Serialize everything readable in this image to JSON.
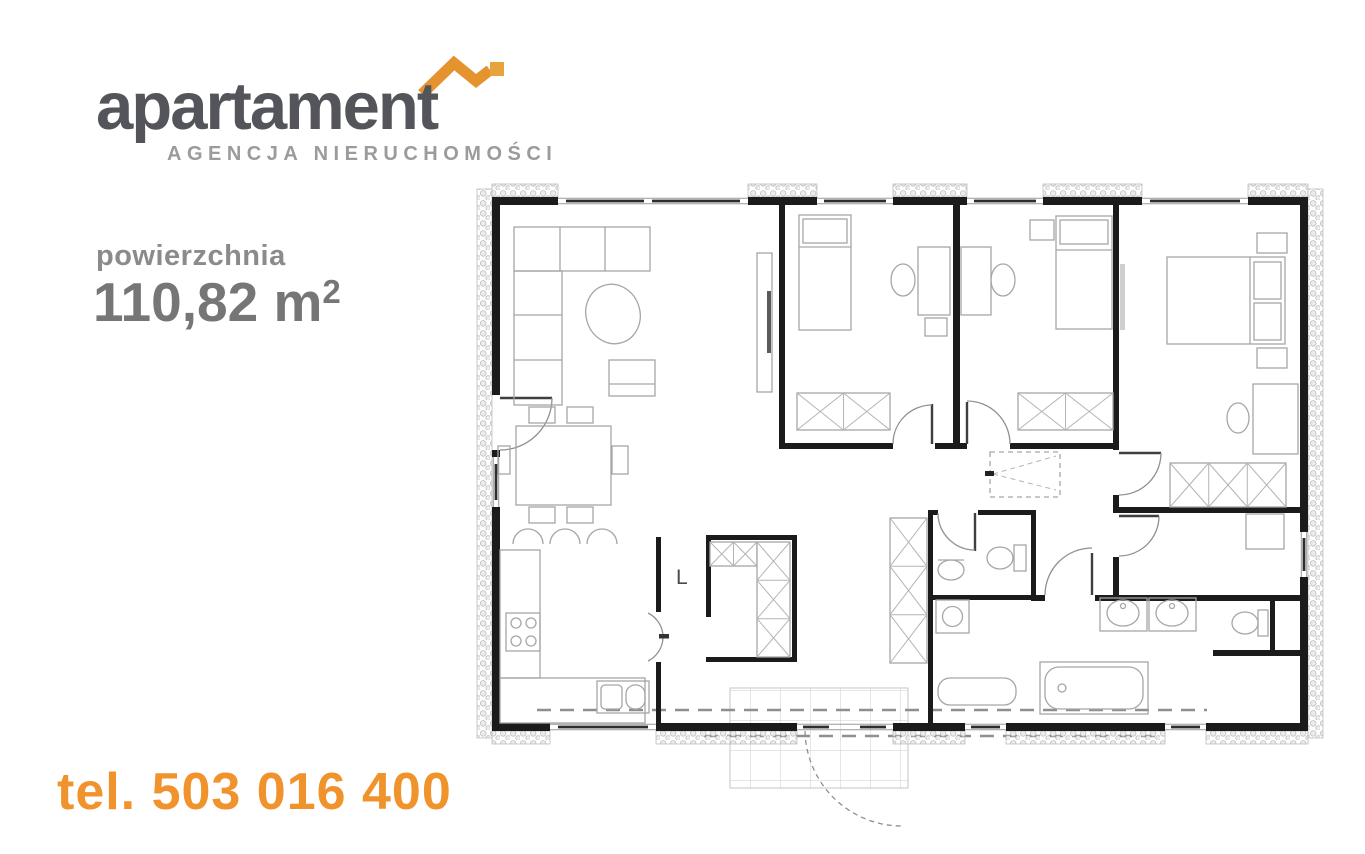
{
  "logo": {
    "brand": "apartament",
    "subtitle": "AGENCJA NIERUCHOMOŚCI",
    "brand_color": "#54555a",
    "subtitle_color": "#9b9b9b",
    "roof_icon": "roof-with-chimney",
    "roof_color": "#e5932e",
    "roof_chimney_color": "#e9a33c"
  },
  "area": {
    "label": "powierzchnia",
    "value": "110,82",
    "unit": " m",
    "superscript": "2",
    "text_color": "#7b7b7b"
  },
  "phone": {
    "text": "tel. 503 016 400",
    "color": "#f0932c"
  },
  "floor_plan": {
    "type": "single-storey house plan",
    "label_l": "L",
    "wall_color": "#1b1b1b",
    "furniture_color": "#a6a6a6",
    "hatch_color": "#bdbdbd",
    "terrace_grid_color": "#cccccc"
  }
}
